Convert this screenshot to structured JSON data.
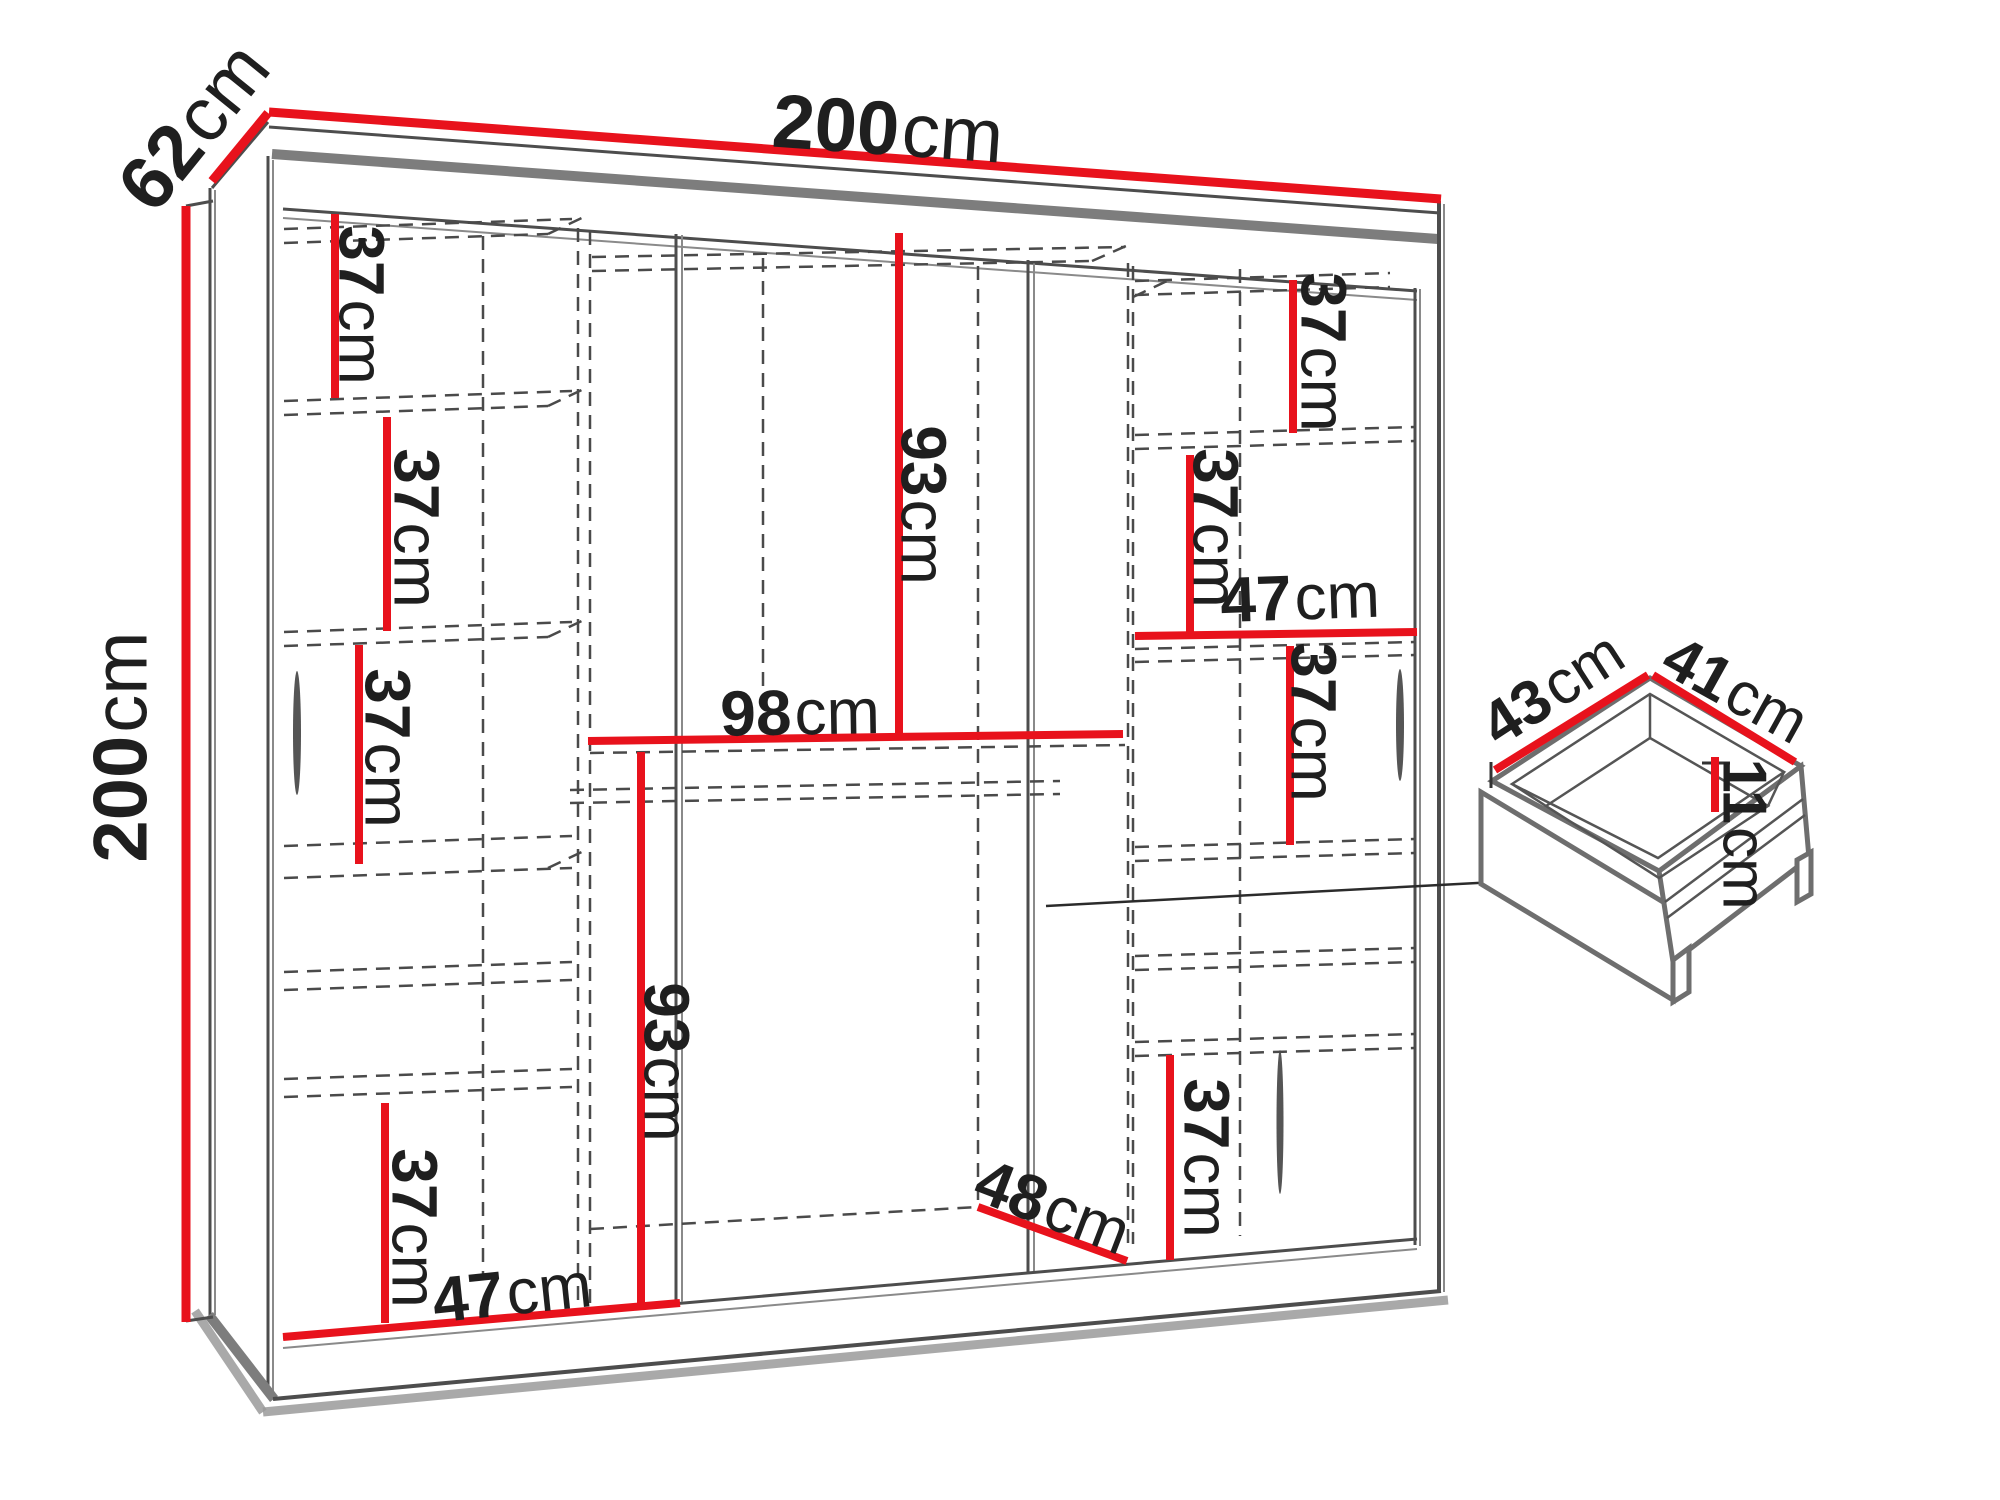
{
  "colors": {
    "dimension_red": "#e8121c",
    "line_dark": "#4d4d4d",
    "panel_gray": "#7d7d7d",
    "dashed_gray": "#4a4a4a",
    "text": "#1f1f1f",
    "shadow_gray": "#9a9a9a",
    "background": "#ffffff"
  },
  "wardrobe": {
    "width": {
      "value": "200",
      "unit": "cm"
    },
    "height": {
      "value": "200",
      "unit": "cm"
    },
    "depth": {
      "value": "62",
      "unit": "cm"
    },
    "left_column": {
      "shelf_gap_1": {
        "value": "37",
        "unit": "cm"
      },
      "shelf_gap_2": {
        "value": "37",
        "unit": "cm"
      },
      "shelf_gap_3": {
        "value": "37",
        "unit": "cm"
      },
      "bottom_gap": {
        "value": "37",
        "unit": "cm"
      },
      "width": {
        "value": "47",
        "unit": "cm"
      }
    },
    "middle_column": {
      "upper_hanging": {
        "value": "93",
        "unit": "cm"
      },
      "width": {
        "value": "98",
        "unit": "cm"
      },
      "lower_hanging": {
        "value": "93",
        "unit": "cm"
      },
      "floor_depth": {
        "value": "48",
        "unit": "cm"
      }
    },
    "right_column": {
      "shelf_gap_1": {
        "value": "37",
        "unit": "cm"
      },
      "shelf_gap_2": {
        "value": "37",
        "unit": "cm"
      },
      "width": {
        "value": "47",
        "unit": "cm"
      },
      "shelf_gap_3": {
        "value": "37",
        "unit": "cm"
      },
      "bottom_gap": {
        "value": "37",
        "unit": "cm"
      }
    }
  },
  "drawer": {
    "width": {
      "value": "43",
      "unit": "cm"
    },
    "depth": {
      "value": "41",
      "unit": "cm"
    },
    "height": {
      "value": "11",
      "unit": "cm"
    }
  }
}
